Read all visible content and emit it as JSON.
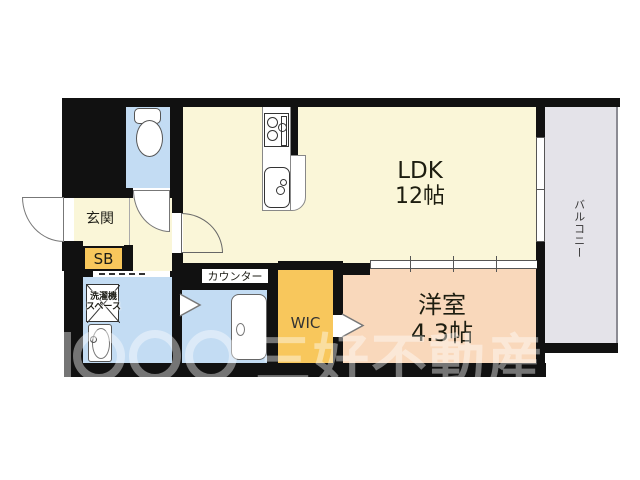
{
  "plan": {
    "rooms": {
      "ldk": {
        "label": "LDK",
        "size": "12帖"
      },
      "western_room": {
        "label": "洋室",
        "size": "4.3帖"
      },
      "entrance": {
        "label": "玄関"
      },
      "shoe_box": {
        "label": "SB"
      },
      "wic": {
        "label": "WIC"
      },
      "counter": {
        "label": "カウンター"
      },
      "laundry_space": {
        "line1": "洗濯機",
        "line2": "スペース"
      },
      "balcony": {
        "label": "バルコニー"
      }
    },
    "colors": {
      "wall": "#111111",
      "room-cream": "#faf6d8",
      "room-blue": "#c3dcf3",
      "room-orange": "#f8c75c",
      "room-pink": "#f9d8bb",
      "balcony-gray": "#e4e3e9"
    }
  },
  "watermark": {
    "company": "三好不動産"
  }
}
